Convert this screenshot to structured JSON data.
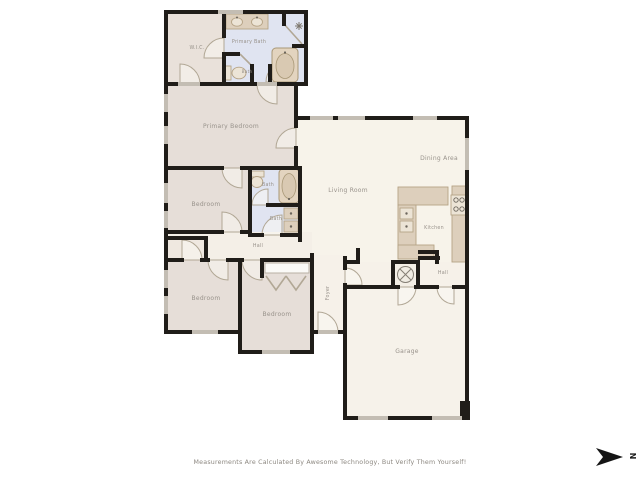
{
  "colors": {
    "wall": "#201d19",
    "floor_cream": "#f7f3ea",
    "floor_beige": "#e6ded8",
    "floor_bath_blue": "#e0e4f1",
    "fixture_tan": "#ddcfbc",
    "window_gray": "#c3bdb3",
    "label_gray": "#98928b"
  },
  "rooms": {
    "wic": {
      "label": "W.I.C."
    },
    "primary_bath": {
      "label": "Primary Bath"
    },
    "bath_top": {
      "label": "Bath"
    },
    "primary_bedroom": {
      "label": "Primary Bedroom"
    },
    "bedroom_mid": {
      "label": "Bedroom"
    },
    "bath_mid": {
      "label": "Bath"
    },
    "bath_lower": {
      "label": "Bath"
    },
    "hall_left": {
      "label": "Hall"
    },
    "living_room": {
      "label": "Living Room"
    },
    "dining_area": {
      "label": "Dining Area"
    },
    "kitchen": {
      "label": "Kitchen"
    },
    "bedroom_left": {
      "label": "Bedroom"
    },
    "bedroom_center": {
      "label": "Bedroom"
    },
    "foyer": {
      "label": "Foyer"
    },
    "hall_right": {
      "label": "Hall"
    },
    "garage": {
      "label": "Garage"
    }
  },
  "compass": {
    "label": "N"
  },
  "footer": {
    "disclaimer": "Measurements Are Calculated By Awesome Technology, But Verify Them Yourself!"
  }
}
